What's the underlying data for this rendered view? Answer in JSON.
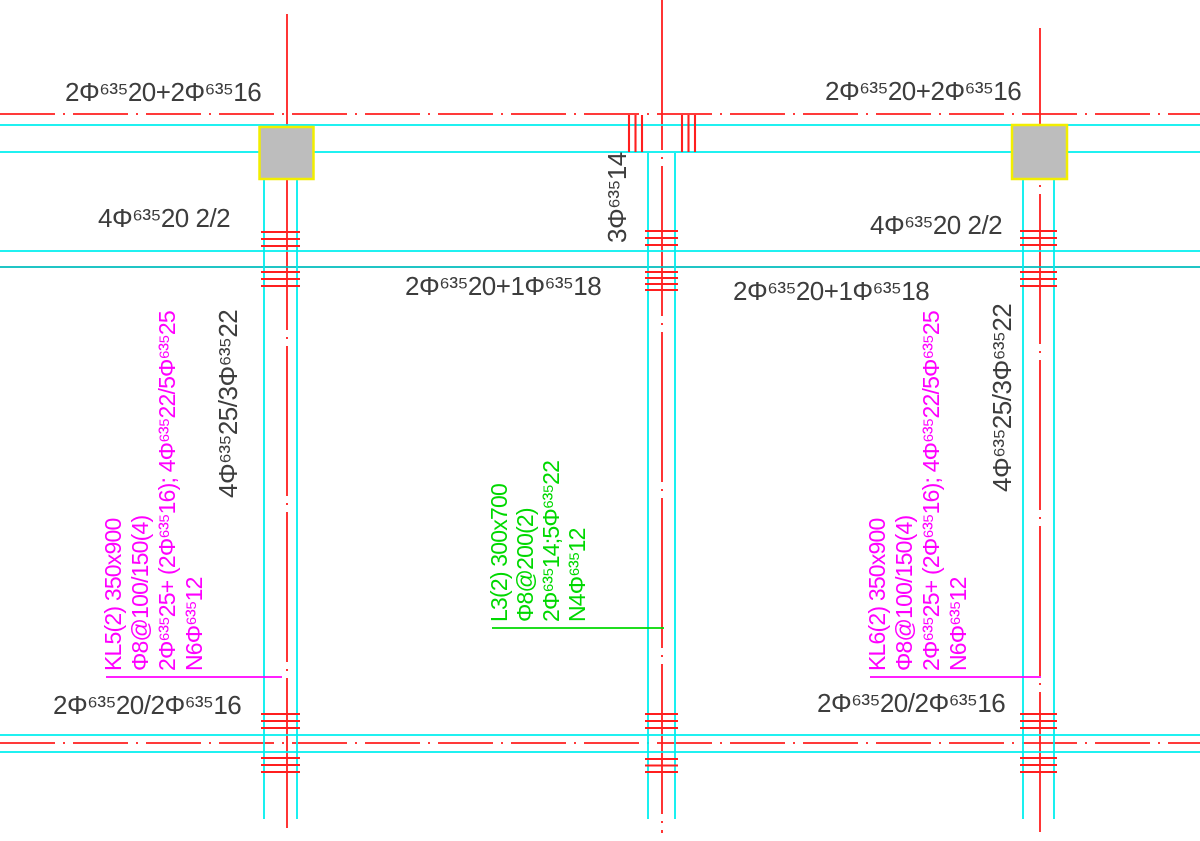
{
  "palette": {
    "red": "#ff1f1f",
    "cyan": "#00efef",
    "teal": "#00bdbd",
    "magenta": "#ff00ff",
    "green": "#00d800",
    "yellow": "#f2ee00",
    "gray": "#bdbdbd",
    "ink": "#3d3d3d",
    "bg": "#ffffff"
  },
  "labels": {
    "top_left": "2Φ⁶³⁵20+2Φ⁶³⁵16",
    "top_right": "2Φ⁶³⁵20+2Φ⁶³⁵16",
    "support_left": "4Φ⁶³⁵20 2/2",
    "support_right": "4Φ⁶³⁵20 2/2",
    "mid_left": "2Φ⁶³⁵20+1Φ⁶³⁵18",
    "mid_right": "2Φ⁶³⁵20+1Φ⁶³⁵18",
    "bottom_left": "2Φ⁶³⁵20/2Φ⁶³⁵16",
    "bottom_right": "2Φ⁶³⁵20/2Φ⁶³⁵16",
    "hanger_center": "3Φ⁶³⁵14",
    "side_left": "4Φ⁶³⁵25/3Φ⁶³⁵22",
    "side_right": "4Φ⁶³⁵25/3Φ⁶³⁵22"
  },
  "beams": {
    "kl5": {
      "lines": [
        "KL5(2) 350x900",
        "Φ8@100/150(4)",
        "2Φ⁶³⁵25+ (2Φ⁶³⁵16); 4Φ⁶³⁵22/5Φ⁶³⁵25",
        "N6Φ⁶³⁵12"
      ]
    },
    "l3": {
      "lines": [
        "L3(2) 300x700",
        "Φ8@200(2)",
        "2Φ⁶³⁵14;5Φ⁶³⁵22",
        "N4Φ⁶³⁵12"
      ]
    },
    "kl6": {
      "lines": [
        "KL6(2) 350x900",
        "Φ8@100/150(4)",
        "2Φ⁶³⁵25+ (2Φ⁶³⁵16); 4Φ⁶³⁵22/5Φ⁶³⁵25",
        "N6Φ⁶³⁵12"
      ]
    }
  }
}
